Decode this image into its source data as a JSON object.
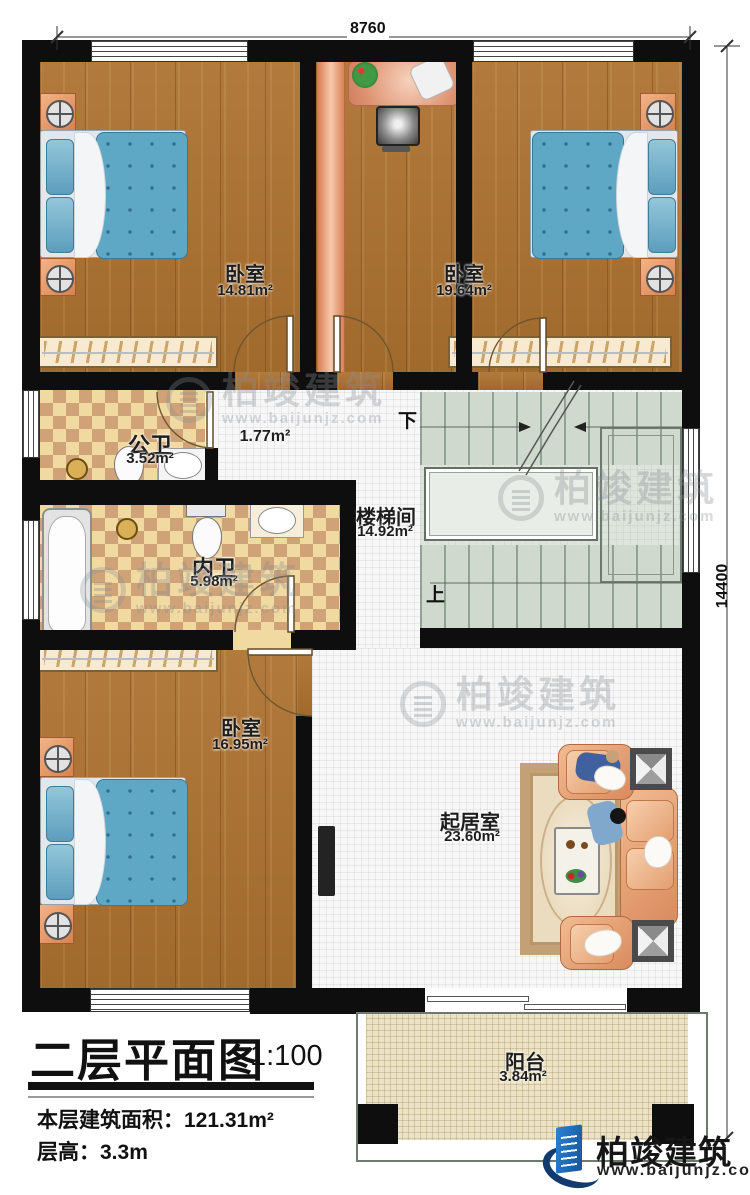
{
  "title_block": {
    "title": "二层平面图",
    "scale": "1:100",
    "area_label": "本层建筑面积：",
    "area_value": "121.31m²",
    "height_label": "层高：",
    "height_value": "3.3m"
  },
  "dimensions": {
    "top": "8760",
    "right": "14400"
  },
  "stairs": {
    "down_label": "下",
    "up_label": "上"
  },
  "rooms": {
    "bedroom_nw": {
      "name": "卧室",
      "area": "14.81m²"
    },
    "bedroom_ne": {
      "name": "卧室",
      "area": "19.64m²"
    },
    "public_bath": {
      "name": "公卫",
      "area": "3.52m²"
    },
    "hall": {
      "area": "1.77m²"
    },
    "ensuite_bath": {
      "name": "内卫",
      "area": "5.98m²"
    },
    "stairwell": {
      "name": "楼梯间",
      "area": "14.92m²"
    },
    "bedroom_sw": {
      "name": "卧室",
      "area": "16.95m²"
    },
    "living": {
      "name": "起居室",
      "area": "23.60m²"
    },
    "balcony": {
      "name": "阳台",
      "area": "3.84m²"
    }
  },
  "brand": {
    "name": "柏竣建筑",
    "website": "www.baijunjz.com"
  },
  "watermark": {
    "name": "柏竣建筑",
    "website": "www.baijunjz.com"
  },
  "colors": {
    "wall": "#0e0e0e",
    "wood_floor": "#ad7230",
    "bath_tile_light": "#f1d9a2",
    "bath_tile_dark": "#cfa377",
    "stair_floor": "#dde4dc",
    "balcony_floor": "#ece3c6",
    "bed_quilt": "#5ea8c6",
    "sofa": "#e8a87a",
    "brand_blue": "#1b6ab3"
  }
}
